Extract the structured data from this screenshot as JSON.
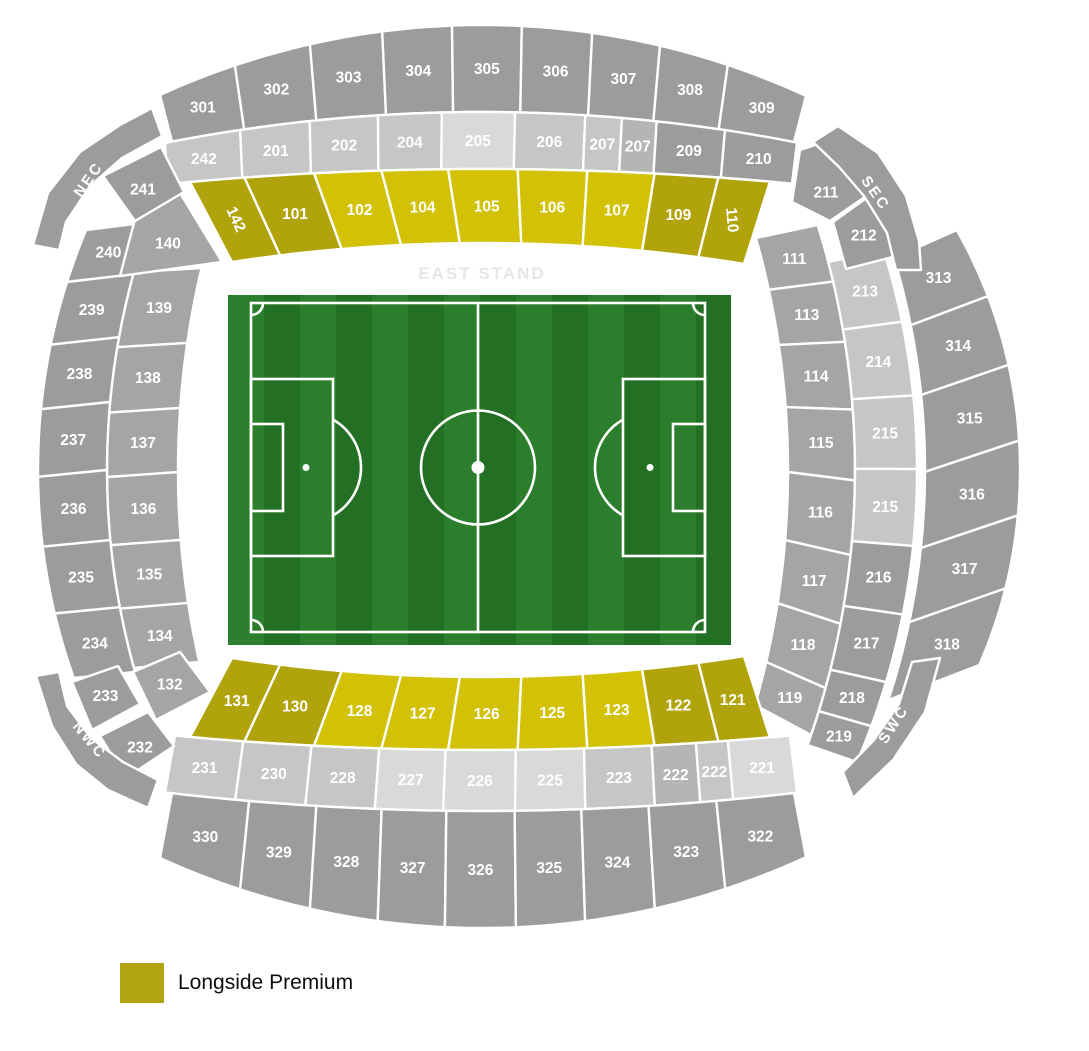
{
  "stand_label": "EAST STAND",
  "legend": {
    "label": "Longside Premium",
    "color": "#b1a410"
  },
  "map": {
    "width": 1089,
    "height": 1051,
    "colors": {
      "g1": "#9c9c9c",
      "g2": "#a5a5a5",
      "lg": "#c6c6c6",
      "ll": "#d9d9d9",
      "md": "#b5b5b5",
      "yb": "#d2c104",
      "yd": "#b1a30c"
    },
    "stroke": "#ffffff",
    "bands": [
      {
        "id": "top-300s",
        "o": "h",
        "ax": 482,
        "c": "g1",
        "e1": {
          "c": 25,
          "R": 776,
          "s": 1,
          "a": 160,
          "b": 806
        },
        "e2": {
          "c": 112,
          "R": 1636,
          "s": 1,
          "a": 172,
          "b": 794
        },
        "sec": [
          [
            "301",
            0,
            0.116
          ],
          [
            "302",
            0.116,
            0.232
          ],
          [
            "303",
            0.232,
            0.344
          ],
          [
            "304",
            0.344,
            0.452
          ],
          [
            "305",
            0.452,
            0.56
          ],
          [
            "306",
            0.56,
            0.669
          ],
          [
            "307",
            0.669,
            0.774
          ],
          [
            "308",
            0.774,
            0.879
          ],
          [
            "309",
            0.879,
            1
          ]
        ]
      },
      {
        "id": "top-200s",
        "o": "h",
        "ax": 482,
        "c": "lg",
        "e1": {
          "c": 112,
          "R": 1636,
          "s": 1,
          "a": 165,
          "b": 797
        },
        "e2": {
          "c": 169,
          "R": 3286,
          "s": 1,
          "a": 168,
          "b": 792
        },
        "sec": [
          [
            "242",
            0,
            0.119
          ],
          [
            "201",
            0.119,
            0.229
          ],
          [
            "202",
            0.229,
            0.337
          ],
          [
            "204",
            0.337,
            0.438
          ],
          [
            "205",
            0.438,
            0.554,
            "ll"
          ],
          [
            "206",
            0.554,
            0.665
          ],
          [
            "207",
            0.665,
            0.723
          ],
          [
            "207",
            0.723,
            0.778,
            "md"
          ],
          [
            "209",
            0.778,
            0.886,
            "g1"
          ],
          [
            "210",
            0.886,
            1,
            "g1"
          ]
        ]
      },
      {
        "id": "top-100s",
        "o": "h",
        "ax": 482,
        "c": "yb",
        "e1": {
          "c": 169,
          "R": 3286,
          "s": 1,
          "a": 190,
          "b": 770
        },
        "e2": {
          "c": 243,
          "R": 1654,
          "s": 1,
          "a": 232,
          "b": 744
        },
        "sec": [
          [
            "142",
            0,
            0.094,
            "yd",
            65
          ],
          [
            "101",
            0.094,
            0.214,
            "yd"
          ],
          [
            "102",
            0.214,
            0.33
          ],
          [
            "104",
            0.33,
            0.445
          ],
          [
            "105",
            0.445,
            0.565
          ],
          [
            "106",
            0.565,
            0.685
          ],
          [
            "107",
            0.685,
            0.801
          ],
          [
            "109",
            0.801,
            0.911,
            "yd"
          ],
          [
            "110",
            0.911,
            1,
            "yd",
            85
          ]
        ]
      },
      {
        "id": "right-100s",
        "o": "v",
        "ax": 470,
        "c": "g2",
        "e1": {
          "c": 788,
          "R": 855,
          "s": -1,
          "a": 238,
          "b": 705
        },
        "e2": {
          "c": 855,
          "R": 822,
          "s": -1,
          "a": 225,
          "b": 735
        },
        "sec": [
          [
            "111",
            0,
            0.111
          ],
          [
            "113",
            0.111,
            0.229
          ],
          [
            "114",
            0.229,
            0.362
          ],
          [
            "115",
            0.362,
            0.501
          ],
          [
            "116",
            0.501,
            0.647
          ],
          [
            "117",
            0.647,
            0.782
          ],
          [
            "118",
            0.782,
            0.908
          ],
          [
            "119",
            0.908,
            1
          ]
        ]
      },
      {
        "id": "right-200s",
        "o": "v",
        "ax": 470,
        "c": "lg",
        "e1": {
          "c": 855,
          "R": 822,
          "s": -1,
          "a": 262,
          "b": 745
        },
        "e2": {
          "c": 917,
          "R": 741,
          "s": -1,
          "a": 250,
          "b": 762
        },
        "sec": [
          [
            "213",
            0,
            0.14
          ],
          [
            "214",
            0.14,
            0.284
          ],
          [
            "215",
            0.284,
            0.428
          ],
          [
            "215",
            0.428,
            0.578
          ],
          [
            "216",
            0.578,
            0.712,
            "g1"
          ],
          [
            "217",
            0.712,
            0.844,
            "g1"
          ],
          [
            "218",
            0.844,
            0.93,
            "g1"
          ],
          [
            "219",
            0.93,
            1,
            "g1"
          ]
        ]
      },
      {
        "id": "right-300s",
        "o": "v",
        "ax": 470,
        "c": "g1",
        "e1": {
          "c": 925,
          "R": 741,
          "s": -1,
          "a": 258,
          "b": 700
        },
        "e2": {
          "c": 1020,
          "R": 487,
          "s": -1,
          "a": 230,
          "b": 665
        },
        "sec": [
          [
            "313",
            0,
            0.152
          ],
          [
            "314",
            0.152,
            0.31
          ],
          [
            "315",
            0.31,
            0.484
          ],
          [
            "316",
            0.484,
            0.656
          ],
          [
            "317",
            0.656,
            0.824
          ],
          [
            "318",
            0.824,
            1
          ]
        ]
      },
      {
        "id": "bottom-100s",
        "o": "h",
        "ax": 482,
        "c": "yb",
        "e1": {
          "c": 677,
          "R": 1654,
          "s": -1,
          "a": 232,
          "b": 744
        },
        "e2": {
          "c": 750,
          "R": 3286,
          "s": -1,
          "a": 190,
          "b": 770
        },
        "sec": [
          [
            "131",
            0,
            0.094,
            "yd"
          ],
          [
            "130",
            0.094,
            0.214,
            "yd"
          ],
          [
            "128",
            0.214,
            0.33
          ],
          [
            "127",
            0.33,
            0.445
          ],
          [
            "126",
            0.445,
            0.565
          ],
          [
            "125",
            0.565,
            0.685
          ],
          [
            "123",
            0.685,
            0.801
          ],
          [
            "122",
            0.801,
            0.911,
            "yd"
          ],
          [
            "121",
            0.911,
            1,
            "yd"
          ]
        ]
      },
      {
        "id": "bottom-200s",
        "o": "h",
        "ax": 482,
        "c": "lg",
        "e1": {
          "c": 750,
          "R": 3286,
          "s": -1,
          "a": 175,
          "b": 790
        },
        "e2": {
          "c": 811,
          "R": 2713,
          "s": -1,
          "a": 165,
          "b": 797
        },
        "sec": [
          [
            "231",
            0,
            0.111
          ],
          [
            "230",
            0.111,
            0.222
          ],
          [
            "228",
            0.222,
            0.332
          ],
          [
            "227",
            0.332,
            0.44,
            "ll"
          ],
          [
            "226",
            0.44,
            0.554,
            "ll"
          ],
          [
            "225",
            0.554,
            0.665,
            "ll"
          ],
          [
            "223",
            0.665,
            0.775
          ],
          [
            "222",
            0.775,
            0.847,
            "md"
          ],
          [
            "222",
            0.847,
            0.899
          ],
          [
            "221",
            0.899,
            1,
            "ll"
          ]
        ]
      },
      {
        "id": "bottom-300s",
        "o": "h",
        "ax": 482,
        "c": "g1",
        "e1": {
          "c": 811,
          "R": 2713,
          "s": -1,
          "a": 172,
          "b": 794
        },
        "e2": {
          "c": 928,
          "R": 776,
          "s": -1,
          "a": 160,
          "b": 806
        },
        "sec": [
          [
            "330",
            0,
            0.124
          ],
          [
            "329",
            0.124,
            0.232
          ],
          [
            "328",
            0.232,
            0.337
          ],
          [
            "327",
            0.337,
            0.441
          ],
          [
            "326",
            0.441,
            0.551
          ],
          [
            "325",
            0.551,
            0.658
          ],
          [
            "324",
            0.658,
            0.766
          ],
          [
            "323",
            0.766,
            0.875
          ],
          [
            "322",
            0.875,
            1
          ]
        ]
      },
      {
        "id": "left-100s",
        "o": "v",
        "ax": 470,
        "c": "g2",
        "e1": {
          "c": 178,
          "R": 878,
          "s": 1,
          "a": 268,
          "b": 662
        },
        "e2": {
          "c": 107,
          "R": 741,
          "s": 1,
          "a": 272,
          "b": 668
        },
        "sec": [
          [
            "139",
            0,
            0.19
          ],
          [
            "138",
            0.19,
            0.355
          ],
          [
            "137",
            0.355,
            0.518
          ],
          [
            "136",
            0.518,
            0.69
          ],
          [
            "135",
            0.69,
            0.85
          ],
          [
            "134",
            0.85,
            1
          ]
        ]
      },
      {
        "id": "left-200s",
        "o": "v",
        "ax": 470,
        "c": "g1",
        "e1": {
          "c": 107,
          "R": 741,
          "s": 1,
          "a": 222,
          "b": 672
        },
        "e2": {
          "c": 38,
          "R": 623,
          "s": 1,
          "a": 230,
          "b": 678
        },
        "sec": [
          [
            "240",
            0,
            0.116
          ],
          [
            "239",
            0.116,
            0.256
          ],
          [
            "238",
            0.256,
            0.4
          ],
          [
            "237",
            0.4,
            0.551
          ],
          [
            "236",
            0.551,
            0.707
          ],
          [
            "235",
            0.707,
            0.856
          ],
          [
            "234",
            0.856,
            1
          ]
        ]
      }
    ],
    "polys": [
      {
        "t": "140",
        "c": "g2",
        "lx": 168,
        "ly": 243,
        "pts": [
          [
            135,
            219
          ],
          [
            180,
            193
          ],
          [
            222,
            262
          ],
          [
            120,
            276
          ]
        ]
      },
      {
        "t": "132",
        "c": "g2",
        "pts": [
          [
            133,
            672
          ],
          [
            180,
            652
          ],
          [
            210,
            692
          ],
          [
            156,
            720
          ]
        ]
      },
      {
        "t": "241",
        "c": "g1",
        "lx": 143,
        "ly": 189,
        "pts": [
          [
            103,
            176
          ],
          [
            161,
            147
          ],
          [
            184,
            192
          ],
          [
            135,
            221
          ]
        ]
      },
      {
        "t": "211",
        "c": "g1",
        "lx": 826,
        "ly": 192,
        "pts": [
          [
            800,
            150
          ],
          [
            848,
            134
          ],
          [
            872,
            192
          ],
          [
            830,
            221
          ],
          [
            792,
            202
          ]
        ]
      },
      {
        "t": "212",
        "c": "g1",
        "pts": [
          [
            833,
            222
          ],
          [
            872,
            194
          ],
          [
            904,
            254
          ],
          [
            846,
            269
          ]
        ]
      },
      {
        "t": "233",
        "c": "g1",
        "pts": [
          [
            72,
            682
          ],
          [
            118,
            666
          ],
          [
            140,
            704
          ],
          [
            92,
            730
          ]
        ]
      },
      {
        "t": "232",
        "c": "g1",
        "lx": 140,
        "ly": 747,
        "pts": [
          [
            100,
            736
          ],
          [
            148,
            712
          ],
          [
            174,
            746
          ],
          [
            126,
            778
          ]
        ]
      },
      {
        "t": "NEC",
        "c": "g1",
        "band": true,
        "r": -55,
        "lx": 88,
        "ly": 179,
        "pts": [
          [
            33,
            245
          ],
          [
            48,
            193
          ],
          [
            80,
            152
          ],
          [
            120,
            125
          ],
          [
            152,
            108
          ],
          [
            162,
            136
          ],
          [
            122,
            158
          ],
          [
            90,
            186
          ],
          [
            66,
            222
          ],
          [
            59,
            250
          ]
        ]
      },
      {
        "t": "SEC",
        "c": "g1",
        "band": true,
        "r": 55,
        "lx": 876,
        "ly": 193,
        "pts": [
          [
            838,
            126
          ],
          [
            878,
            153
          ],
          [
            906,
            196
          ],
          [
            919,
            241
          ],
          [
            921,
            270
          ],
          [
            896,
            270
          ],
          [
            887,
            233
          ],
          [
            864,
            196
          ],
          [
            839,
            167
          ],
          [
            813,
            142
          ]
        ]
      },
      {
        "t": "NWC",
        "c": "g1",
        "band": true,
        "r": 50,
        "lx": 90,
        "ly": 740,
        "pts": [
          [
            36,
            676
          ],
          [
            52,
            726
          ],
          [
            76,
            764
          ],
          [
            108,
            790
          ],
          [
            148,
            808
          ],
          [
            158,
            780
          ],
          [
            123,
            762
          ],
          [
            91,
            738
          ],
          [
            67,
            706
          ],
          [
            59,
            672
          ]
        ]
      },
      {
        "t": "SWC",
        "c": "g1",
        "band": true,
        "r": -57,
        "lx": 893,
        "ly": 724,
        "pts": [
          [
            940,
            658
          ],
          [
            925,
            712
          ],
          [
            893,
            760
          ],
          [
            853,
            798
          ],
          [
            843,
            772
          ],
          [
            874,
            740
          ],
          [
            899,
            704
          ],
          [
            912,
            662
          ]
        ]
      }
    ],
    "pitch": {
      "x": 228,
      "y": 295,
      "w": 503,
      "h": 350,
      "stripe_w": 36,
      "green_a": "#2b7e2b",
      "green_b": "#236f23",
      "line": "#ffffff",
      "line_w": 2.6,
      "border": {
        "x": 251,
        "y": 303,
        "w": 454,
        "h": 329
      },
      "box_w": 82,
      "box_h": 177,
      "goal_w": 32,
      "goal_h": 87,
      "spot_dx": 55,
      "circle_r": 57,
      "arc_r": 55,
      "corner_r": 12,
      "dot_r": 6.5,
      "spot_r": 3.5
    }
  }
}
